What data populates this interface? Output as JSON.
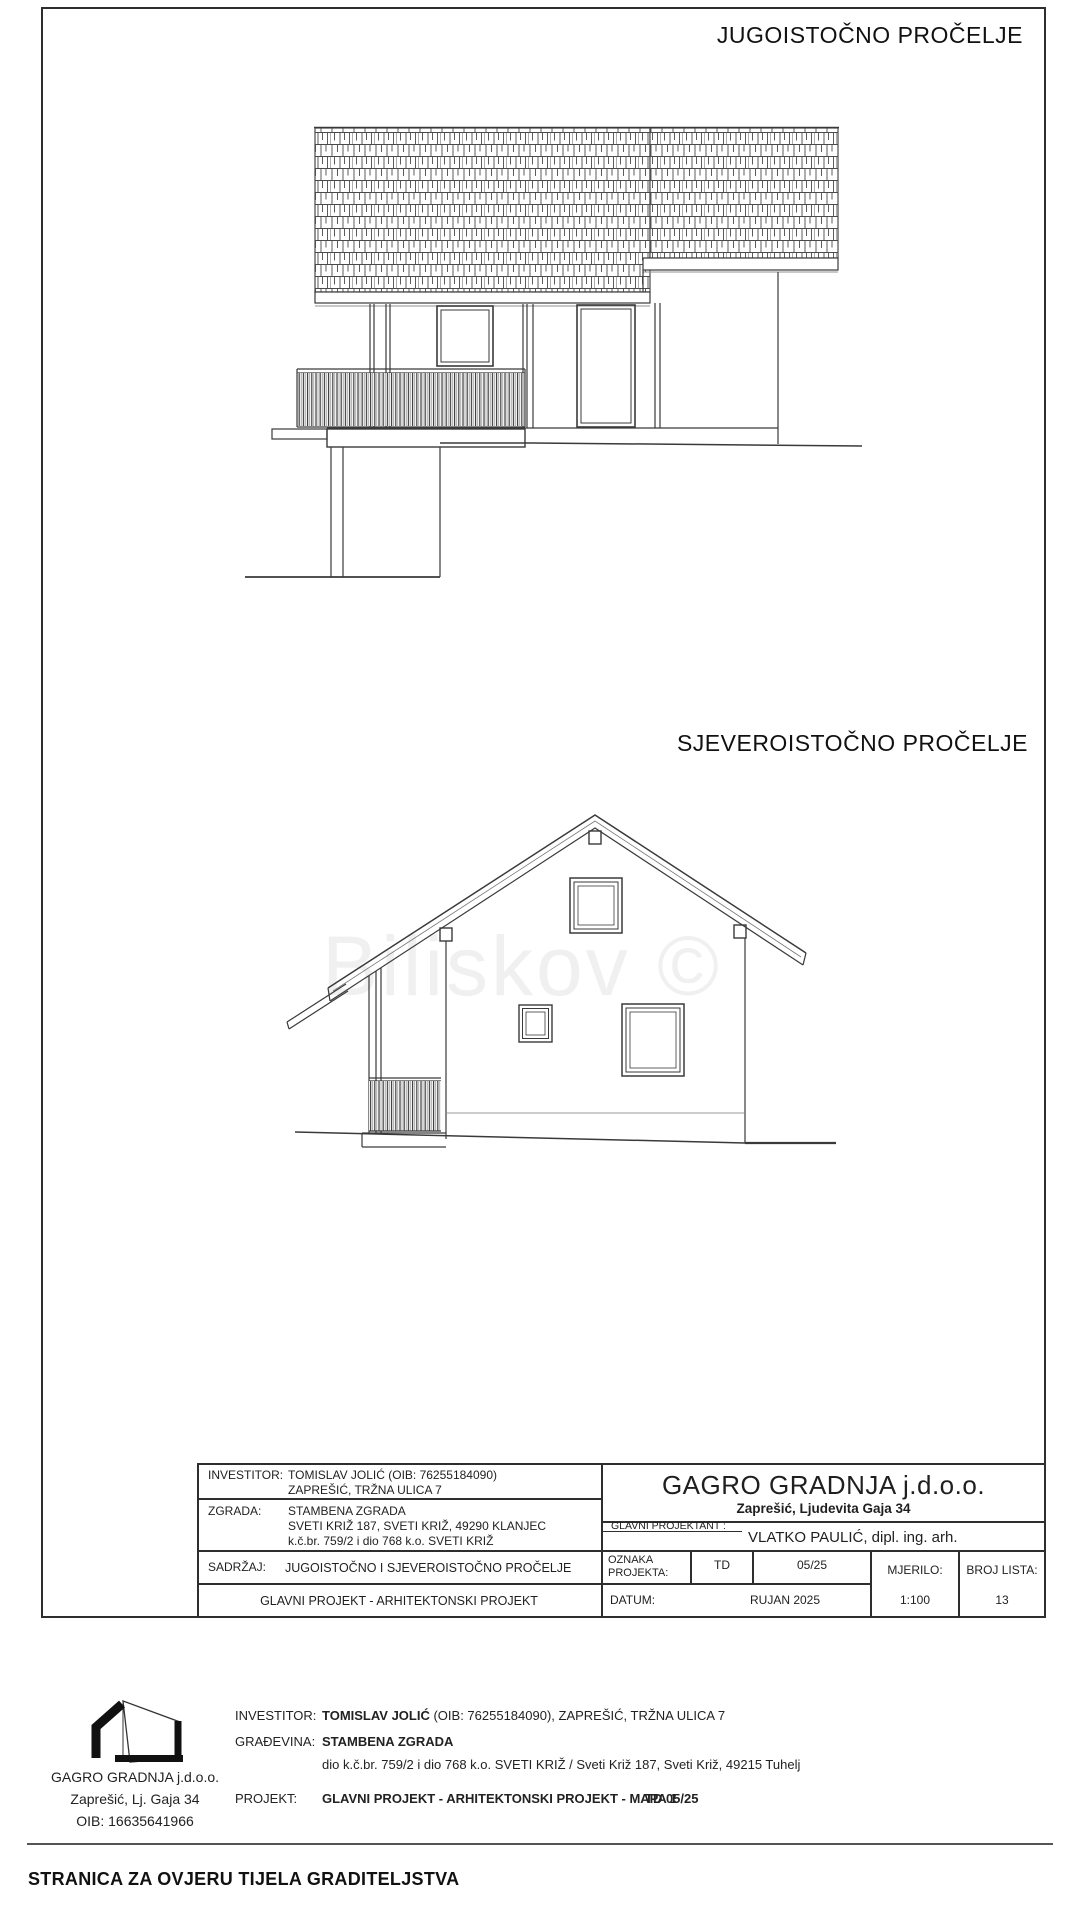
{
  "sheet": {
    "title_elevation1": "JUGOISTOČNO PROČELJE",
    "title_elevation2": "SJEVEROISTOČNO PROČELJE",
    "watermark": "Biliskov ©"
  },
  "title_block": {
    "investitor_label": "INVESTITOR:",
    "investitor_line1": "TOMISLAV JOLIĆ (OIB: 76255184090)",
    "investitor_line2": "ZAPREŠIĆ, TRŽNA ULICA 7",
    "zgrada_label": "ZGRADA:",
    "zgrada_line1": "STAMBENA ZGRADA",
    "zgrada_line2": "SVETI KRIŽ 187, SVETI KRIŽ, 49290 KLANJEC",
    "zgrada_line3": "k.č.br. 759/2 i dio 768  k.o. SVETI KRIŽ",
    "sadrzaj_label": "SADRŽAJ:",
    "sadrzaj_value": "JUGOISTOČNO I SJEVEROISTOČNO PROČELJE",
    "project_row": "GLAVNI PROJEKT - ARHITEKTONSKI PROJEKT",
    "company_name": "GAGRO GRADNJA j.d.o.o.",
    "company_address": "Zaprešić, Ljudevita Gaja 34",
    "glavni_projektant_label": "GLAVNI PROJEKTANT :",
    "glavni_projektant_value": "VLATKO PAULIĆ, dipl. ing. arh.",
    "oznaka_label_line1": "OZNAKA",
    "oznaka_label_line2": "PROJEKTA:",
    "oznaka_td": "TD",
    "oznaka_value": "05/25",
    "mjerilo_label": "MJERILO:",
    "mjerilo_value": "1:100",
    "broj_lista_label": "BROJ LISTA:",
    "broj_lista_value": "13",
    "datum_label": "DATUM:",
    "datum_value": "RUJAN 2025"
  },
  "footer": {
    "logo_company": "GAGRO GRADNJA j.d.o.o.",
    "logo_address": "Zaprešić, Lj. Gaja 34",
    "logo_oib": "OIB: 16635641966",
    "investitor_label": "INVESTITOR:",
    "investitor_name": "TOMISLAV JOLIĆ",
    "investitor_rest": " (OIB: 76255184090), ZAPREŠIĆ, TRŽNA ULICA 7",
    "gradjevina_label": "GRAĐEVINA:",
    "gradjevina_value": "STAMBENA ZGRADA",
    "gradjevina_detail": "dio k.č.br. 759/2 i dio 768  k.o. SVETI KRIŽ / Sveti Križ 187, Sveti Križ, 49215 Tuhelj",
    "projekt_label": "PROJEKT:",
    "projekt_value": "GLAVNI PROJEKT - ARHITEKTONSKI PROJEKT - MAPA 1",
    "projekt_td": "TD 05/25",
    "bottom_title": "STRANICA ZA OVJERU TIJELA GRADITELJSTVA"
  }
}
